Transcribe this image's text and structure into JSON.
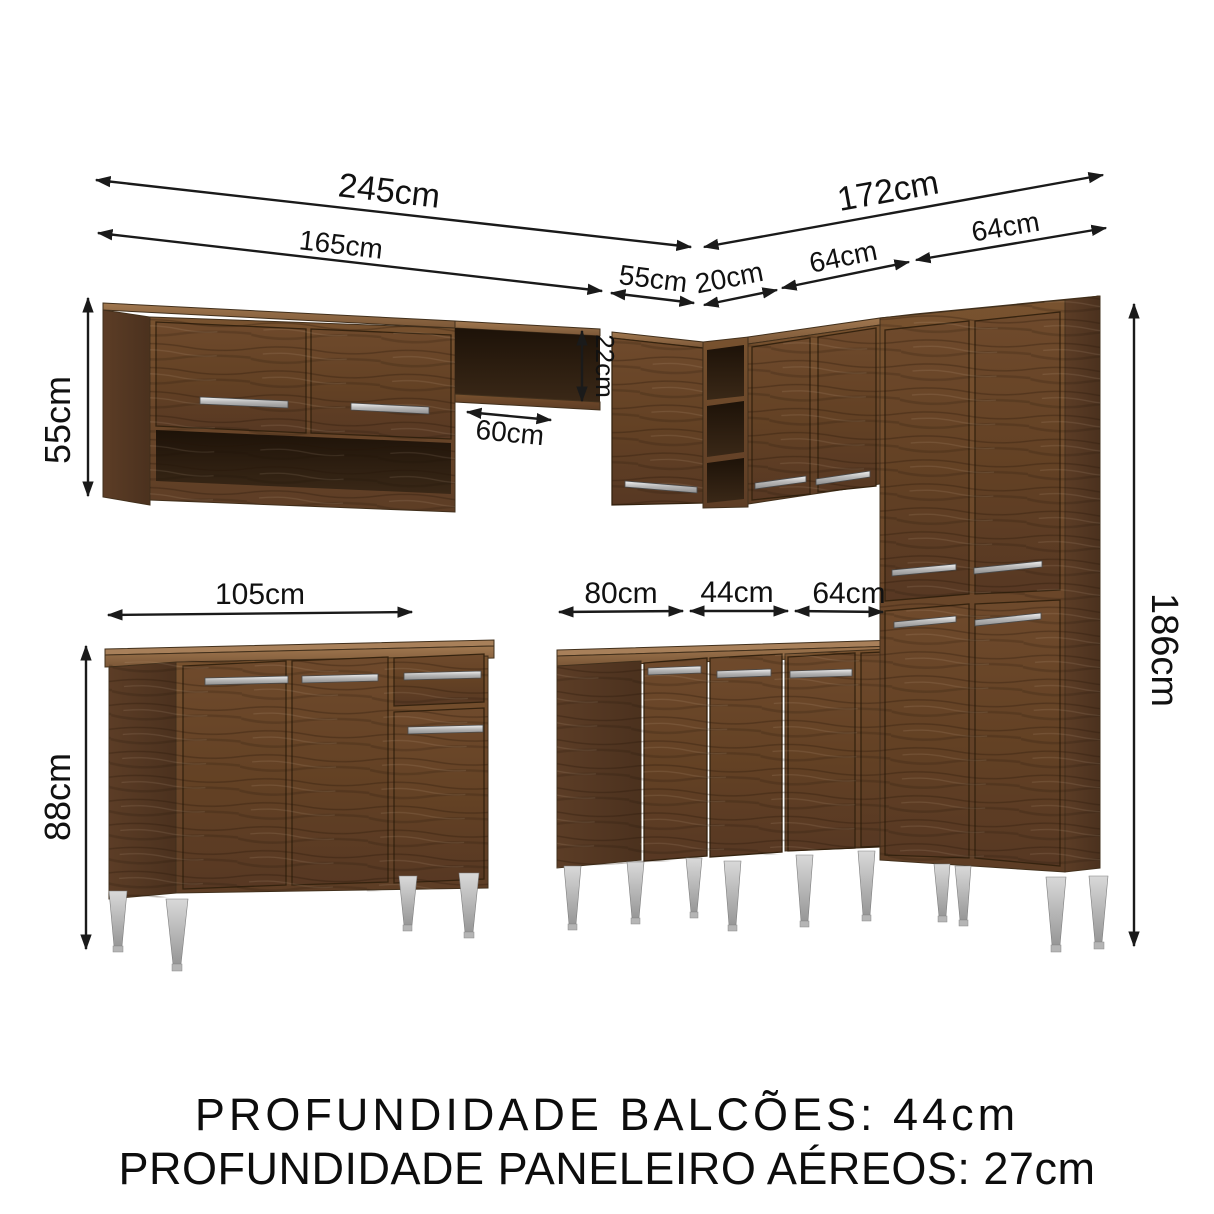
{
  "labels": {
    "total_left": "245cm",
    "total_right": "172cm",
    "upper_left_width": "165cm",
    "corner_door_width": "55cm",
    "corner_shelf_width": "20cm",
    "upper_right_width": "64cm",
    "tall_cabinet_width": "64cm",
    "upper_height": "55cm",
    "niche_height": "22cm",
    "niche_width": "60cm",
    "base_left_width": "105cm",
    "base_corner_width": "80cm",
    "base_corner_door_width": "44cm",
    "base_right_width": "64cm",
    "base_height": "88cm",
    "tall_height": "186cm"
  },
  "footer": {
    "line1": "PROFUNDIDADE BALCÕES: 44cm",
    "line2": "PROFUNDIDADE PANELEIRO AÉREOS: 27cm"
  },
  "colors": {
    "wood": "#6e4a2e",
    "wood_dark": "#4f3420",
    "niche_interior": "#2a1b0f",
    "countertop": "#9b744b",
    "handle_silver": "#c9c9c9",
    "leg_silver": "#b0b0b0",
    "dimension_line": "#1a1a1a",
    "background": "#ffffff"
  }
}
